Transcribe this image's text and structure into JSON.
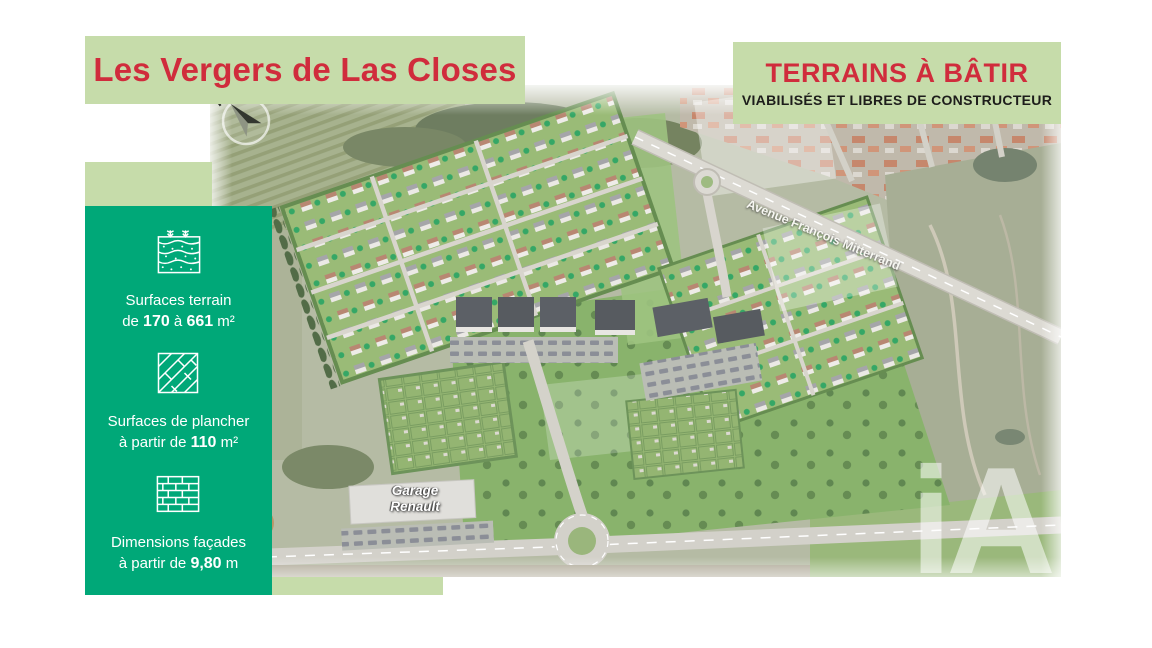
{
  "colors": {
    "accent_red": "#d02c3c",
    "banner_green": "#c6dcaa",
    "panel_green": "#00a878"
  },
  "header": {
    "title": "Les Vergers de Las Closes"
  },
  "offer_banner": {
    "title": "TERRAINS À BÂTIR",
    "subtitle": "VIABILISÉS ET LIBRES DE CONSTRUCTEUR"
  },
  "sidebar": {
    "specs": [
      {
        "icon": "soil-layers-icon",
        "label": "Surfaces terrain",
        "pre": "de ",
        "value1": "170",
        "mid": " à ",
        "value2": "661",
        "unit": " m²"
      },
      {
        "icon": "parquet-floor-icon",
        "label": "Surfaces de plancher",
        "pre": "à partir de ",
        "value1": "110",
        "mid": "",
        "value2": "",
        "unit": " m²"
      },
      {
        "icon": "brick-wall-icon",
        "label": "Dimensions façades",
        "pre": "à partir de ",
        "value1": "9,80",
        "mid": "",
        "value2": "",
        "unit": " m"
      }
    ]
  },
  "map": {
    "compass": "N",
    "street": "Avenue François Mitterrand",
    "garage_line1": "Garage",
    "garage_line2": "Renault",
    "watermark": "iA"
  }
}
